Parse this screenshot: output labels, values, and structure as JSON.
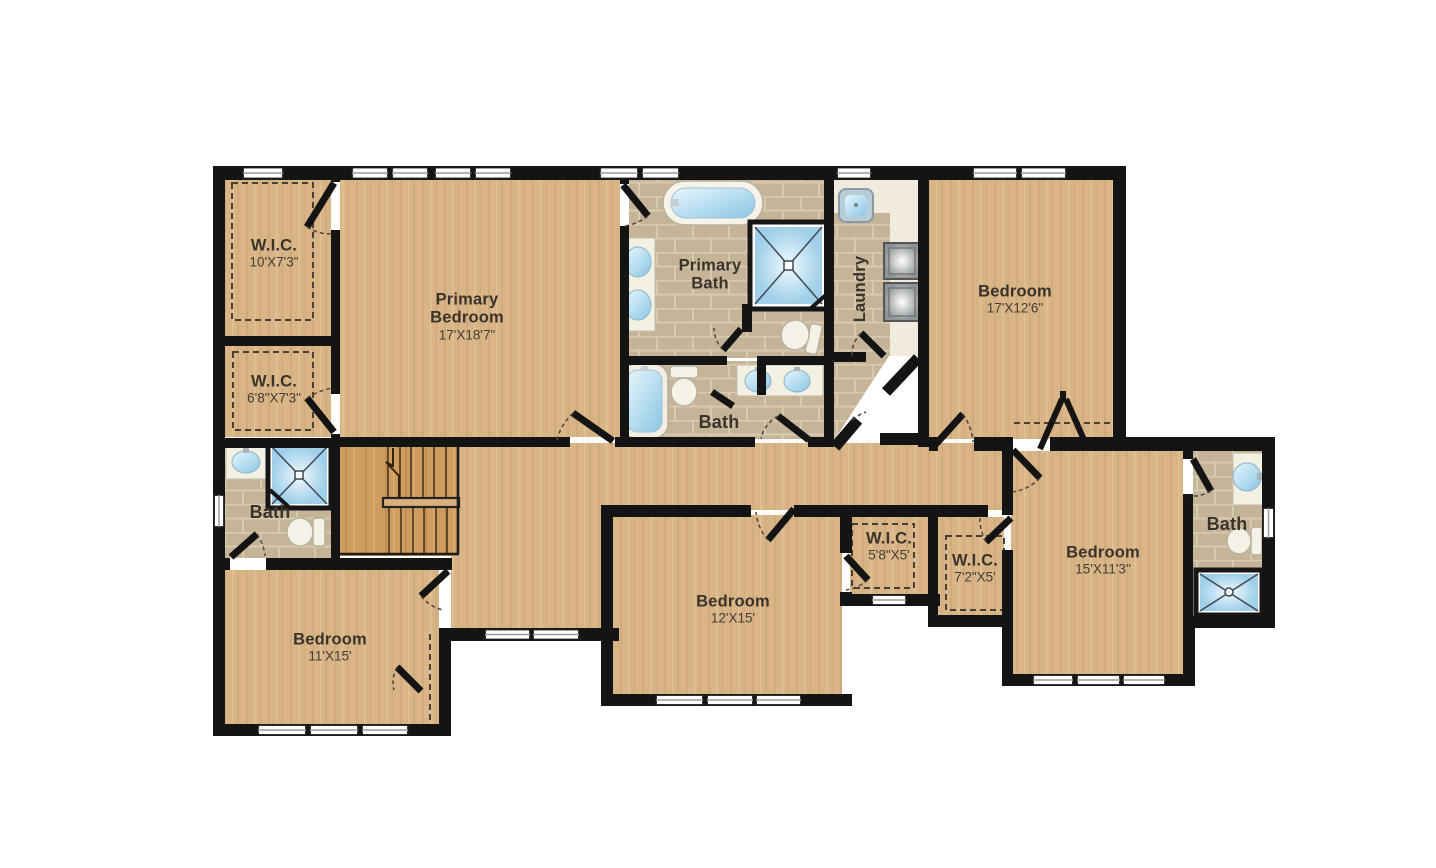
{
  "page": {
    "background": "#ffffff",
    "type": "floor-plan"
  },
  "colors": {
    "wall": "#141414",
    "wood_floor": "#d9b486",
    "stair_wood": "#cf9c5f",
    "tile_floor": "#c6b499",
    "tile_grout": "#d7cab1",
    "counter": "#f2efe3",
    "water_blue": "#a6d2ea",
    "appliance_gray": "#8d9396",
    "label_text": "#39332a"
  },
  "rooms": {
    "wic_top_left": {
      "name": "W.I.C.",
      "dims": "10'X7'3\""
    },
    "wic_mid_left": {
      "name": "W.I.C.",
      "dims": "6'8\"X7'3\""
    },
    "bath_left": {
      "name": "Bath"
    },
    "bedroom_bottom_left": {
      "name": "Bedroom",
      "dims": "11'X15'"
    },
    "primary_bedroom": {
      "name": "Primary Bedroom",
      "dims": "17'X18'7\""
    },
    "primary_bath": {
      "name": "Primary Bath"
    },
    "laundry": {
      "name": "Laundry"
    },
    "bath_middle": {
      "name": "Bath"
    },
    "bedroom_top_right": {
      "name": "Bedroom",
      "dims": "17'X12'6\""
    },
    "bedroom_bottom_mid": {
      "name": "Bedroom",
      "dims": "12'X15'"
    },
    "wic_small": {
      "name": "W.I.C.",
      "dims": "5'8\"X5'"
    },
    "wic_right": {
      "name": "W.I.C.",
      "dims": "7'2\"X5'"
    },
    "bedroom_bottom_right": {
      "name": "Bedroom",
      "dims": "15'X11'3\""
    },
    "bath_right": {
      "name": "Bath"
    }
  },
  "fixtures": {
    "bathtub": "rounded-rect tub with blue water",
    "shower": "square stall with X glass lines",
    "toilet": "bowl ellipse with tank",
    "sink": "oval blue basin on cream vanity",
    "double_vanity": "two oval basins",
    "washer": "gray square appliance",
    "dryer": "gray square appliance",
    "laundry_sink": "small square basin",
    "staircase": "double flight with center rail and up-arrow"
  }
}
